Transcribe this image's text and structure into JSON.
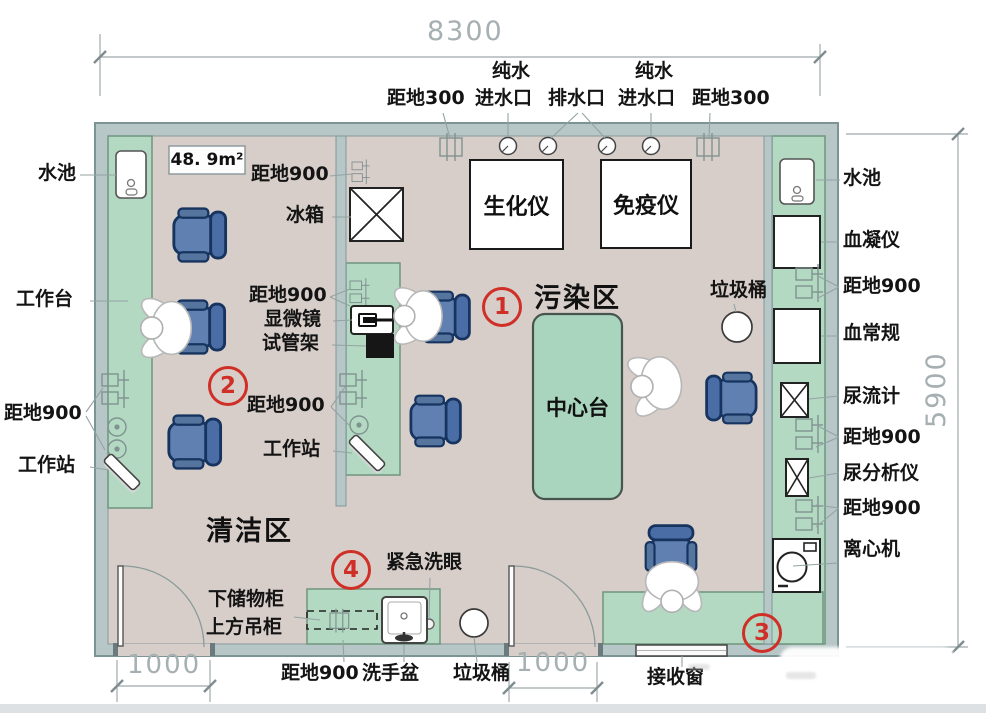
{
  "plan_type": "laboratory-floor-plan",
  "area": "48. 9m²",
  "dimensions": {
    "top_width": "8300",
    "right_height": "5900",
    "door_left": "1000",
    "door_middle": "1000"
  },
  "zones": {
    "contaminated": "污染区",
    "clean": "清洁区",
    "marker1": "1",
    "marker2": "2",
    "marker3": "3",
    "marker4": "4"
  },
  "labels": {
    "sink": "水池",
    "worktable": "工作台",
    "workstation": "工作站",
    "height900": "距地900",
    "height300": "距地300",
    "pure_water": "纯水",
    "water_inlet": "进水口",
    "drain_outlet": "排水口",
    "fridge": "冰箱",
    "microscope": "显微镜",
    "tube_rack": "试管架",
    "biochem_analyzer": "生化仪",
    "immuno_analyzer": "免疫仪",
    "trash_can": "垃圾桶",
    "center_bench": "中心台",
    "coagulation_analyzer": "血凝仪",
    "blood_routine": "血常规",
    "uroflow_meter": "尿流计",
    "urine_analyzer": "尿分析仪",
    "centrifuge": "离心机",
    "emergency_eyewash": "紧急洗眼",
    "lower_cabinet": "下储物柜",
    "upper_cabinet": "上方吊柜",
    "hand_basin": "洗手盆",
    "receiving_window": "接收窗"
  },
  "colors": {
    "wall": "#b7c6c6",
    "floor": "#d7cec9",
    "bench_green": "#b4d9c3",
    "chair_blue": "#6080b2",
    "marker_red": "#cf2f26",
    "dim_grey": "#a6afb2"
  }
}
